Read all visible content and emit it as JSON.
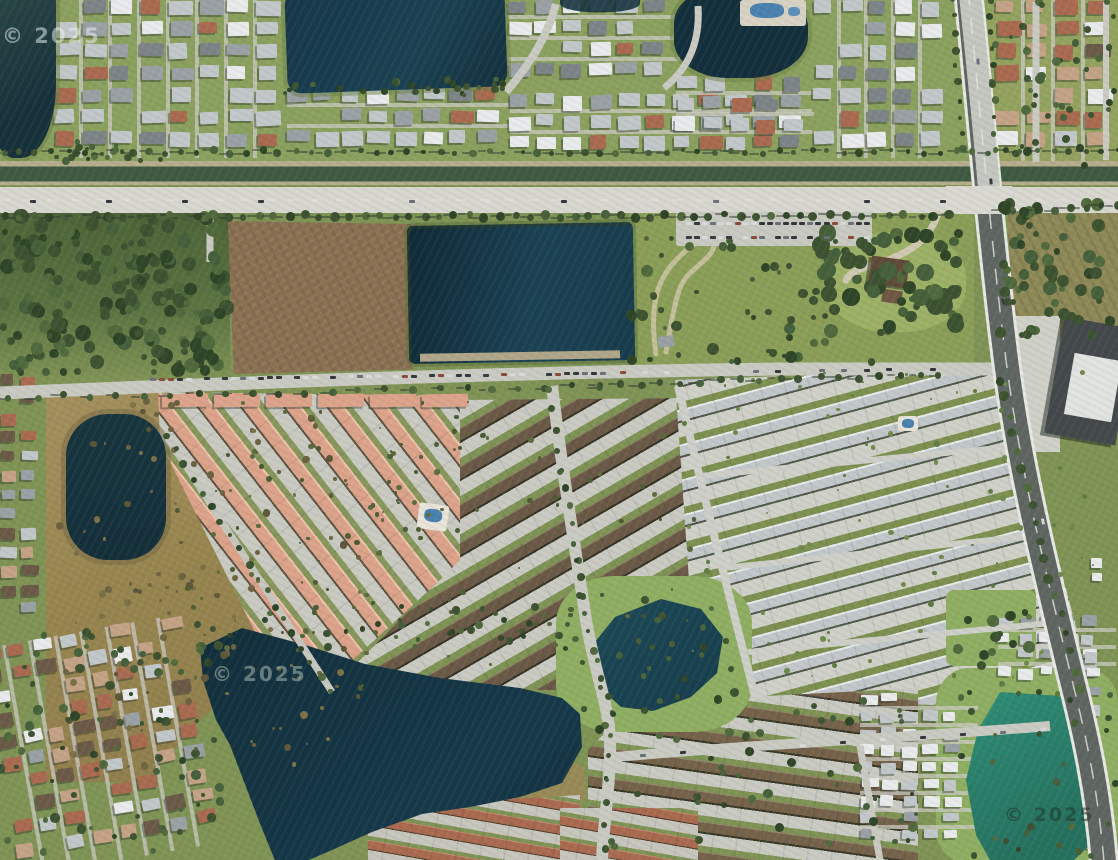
{
  "meta": {
    "view": "satellite-imagery",
    "description": "Aerial satellite view of a suburban area with residential neighborhoods, lakes, a canal road corridor, a vacant dirt lot, townhome communities, a diagonal highway and retention ponds"
  },
  "watermarks": {
    "top_left": "© 2025",
    "mid_left": "© 2025",
    "bottom_right": "© 2025"
  },
  "palette": {
    "water_dark": "#16333f",
    "water_blue": "#1b4252",
    "water_teal": "#1d4a58",
    "water_green": "#2f8f77",
    "canal_green": "#3f5a41",
    "grass_light": "#8fae62",
    "grass_mid": "#7f9355",
    "grass_field": "#8a9e58",
    "grass_dark": "#5d7442",
    "woods": "#4c6236",
    "marsh": "#a4905e",
    "dirt_brown": "#8a7051",
    "sand_path": "#cdc4a4",
    "road_light": "#d7d7cf",
    "road_minor": "#c9cac2",
    "asphalt_dark": "#5f6662",
    "concrete": "#cfd0c8",
    "roof_gray_light": "#c2c7ca",
    "roof_gray_mid": "#9aa1a5",
    "roof_gray_dark": "#7d8488",
    "roof_white": "#e8eaeb",
    "roof_salmon": "#dca38a",
    "roof_salmon_light": "#eec3ab",
    "roof_brown": "#6b5947",
    "roof_tan": "#c4a285",
    "roof_rust": "#a96a50",
    "roof_dark": "#43484b",
    "pool_blue": "#4a81ae",
    "tree_dark": "#3c5230",
    "tree_mid": "#50693c",
    "shadow": "rgba(40,50,40,0.4)"
  },
  "regions": [
    {
      "id": "top-residential-band",
      "kind": "neighborhood"
    },
    {
      "id": "top-left-lake",
      "kind": "water"
    },
    {
      "id": "top-center-lake",
      "kind": "water"
    },
    {
      "id": "top-second-lake",
      "kind": "water"
    },
    {
      "id": "canal-corridor",
      "kind": "canal"
    },
    {
      "id": "main-arterial-road",
      "kind": "road"
    },
    {
      "id": "vacant-dirt-lot",
      "kind": "land"
    },
    {
      "id": "retention-pond",
      "kind": "water"
    },
    {
      "id": "field-with-trail",
      "kind": "land"
    },
    {
      "id": "homestead",
      "kind": "building"
    },
    {
      "id": "diagonal-highway",
      "kind": "road"
    },
    {
      "id": "industrial-warehouse",
      "kind": "building"
    },
    {
      "id": "salmon-roof-community",
      "kind": "neighborhood"
    },
    {
      "id": "brown-roof-community",
      "kind": "neighborhood"
    },
    {
      "id": "gray-townhome-community",
      "kind": "neighborhood"
    },
    {
      "id": "marsh-preserve",
      "kind": "land"
    },
    {
      "id": "small-pond",
      "kind": "water"
    },
    {
      "id": "large-l-shaped-lake",
      "kind": "water"
    },
    {
      "id": "center-pond",
      "kind": "water"
    },
    {
      "id": "green-pond",
      "kind": "water"
    },
    {
      "id": "old-neighborhood-southwest",
      "kind": "neighborhood"
    }
  ]
}
